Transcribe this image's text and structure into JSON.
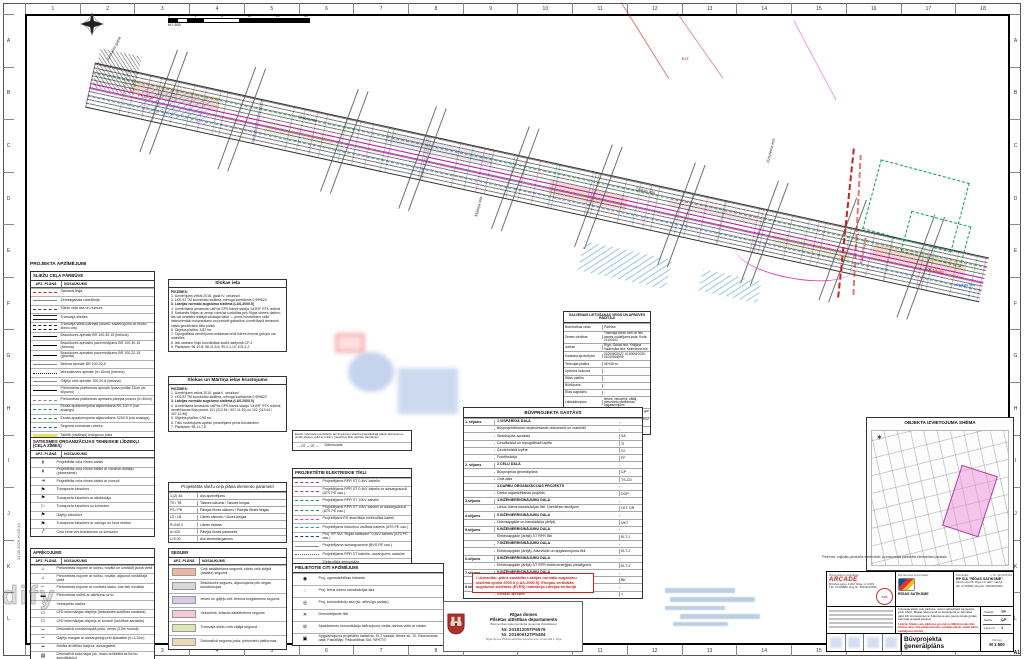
{
  "meta": {
    "sheet_format": "A1",
    "plot_stamp": "24.09.2020 10:15:14",
    "watermark": "dify"
  },
  "frame": {
    "cols": [
      "1",
      "2",
      "3",
      "4",
      "5",
      "6",
      "7",
      "8",
      "9",
      "10",
      "11",
      "12",
      "13",
      "14",
      "15",
      "16",
      "17",
      "18"
    ],
    "rows": [
      "A",
      "B",
      "C",
      "D",
      "E",
      "F",
      "G",
      "H",
      "I",
      "J",
      "K",
      "L"
    ]
  },
  "scalebar": {
    "ticks": [
      "0",
      "1",
      "5",
      "10",
      "20",
      "40"
    ],
    "scale": "M 1:500"
  },
  "legend_title": "PROJEKTA APZĪMĒJUMI",
  "legend_road": {
    "header": "SLIEŽU CEĻA PĀRBŪVE",
    "col1": "APZ. PLĀNĀ",
    "col2": "NOSAUKUMS",
    "rows": [
      {
        "sym": "s-dash-red",
        "label": "Sarkanā līnija"
      },
      {
        "sym": "s-solid-gray",
        "label": "Zemesgabala robežlīnija"
      },
      {
        "sym": "s-axis",
        "label": "Sliežu ceļa ass un numurs"
      },
      {
        "sym": "s-double",
        "label": "Tramvaja sliedes"
      },
      {
        "sym": "s-double-dash",
        "label": "Tramvaja sliežu pārejas posms: savienojums ar esošo sliežu ceļu"
      },
      {
        "sym": "s-solid-black",
        "label": "Brauktuves apmale BR 100.30.15 (betona)"
      },
      {
        "sym": "s-solid-black",
        "label": "Brauktuves apmales pazeminājums BR 100.30.15 (betona)"
      },
      {
        "sym": "s-solid-black",
        "label": "Brauktuves apmales pazeminājums BR 100.22.15 (granīta)"
      },
      {
        "sym": "s-solid-gray",
        "label": "Betona apmale BR 100.20.8"
      },
      {
        "sym": "s-dot-black",
        "label": "Iebrauktuves apmale (h=10cm) (betona)"
      },
      {
        "sym": "s-solid-gray",
        "label": "Gājēju ceļa apmale 100.20.8 (betona)"
      },
      {
        "sym": "s-solid-black",
        "label": "Pieturvietas platformas apmale īpaša profila 33cm (ar slīpumu)"
      },
      {
        "sym": "s-dash-gray",
        "label": "Pieturvietas platformas apmales pārejas posms (h=30cm)"
      },
      {
        "sym": "s-dash-green",
        "label": "Esoša apzaļumojuma atjaunošana RS-100 V (vai analogs)"
      },
      {
        "sym": "s-dash-green",
        "label": "Esoša apzaļumojuma atjaunošana S200.5 (vai analogs)"
      },
      {
        "sym": "s-dash-blue",
        "label": "Seguma nomaiņas robeža"
      },
      {
        "sym": "s-hl-yellow",
        "label": "Taktilā (vadlīniju) iesegumu josla"
      },
      {
        "sym": "s-tree",
        "label": "Esošs, saglabājams koks"
      }
    ]
  },
  "legend_signs": {
    "header": "SATIKSMES ORGANIZĀCIJAS TEHNISKIE LĪDZEKĻI (CEĻA ZĪMES)",
    "col1": "APZ. PLĀNĀ",
    "col2": "NOSAUKUMS",
    "rows": [
      {
        "g": "↟",
        "label": "Projektētās ceļa zīmes balsts"
      },
      {
        "g": "↟",
        "label": "Projektētās ceļa zīmes balsts ar virziena rādītāju (pārnesams)"
      },
      {
        "g": "⇥",
        "label": "Projektētās ceļa zīmes balsts ar konsoli"
      },
      {
        "g": "⚑",
        "label": "Transporta luksofors"
      },
      {
        "g": "⚑",
        "label": "Transporta luksofors ar atkārtotāju"
      },
      {
        "g": "⚐",
        "label": "Transporta luksofors uz konsoles"
      },
      {
        "g": "⚑",
        "label": "Gājēju luksofors"
      },
      {
        "g": "⚑",
        "label": "Transporta luksofors ar vairogu un fona ekrānu"
      },
      {
        "g": "⤤",
        "label": "Ceļa zīme virs brauktuves uz konsoles"
      }
    ]
  },
  "legend_equip": {
    "header": "APRĪKOJUMS",
    "col1": "APZ. PLĀNĀ",
    "col2": "NOSAUKUMS",
    "rows": [
      {
        "g": "⌂",
        "label": "Pieturvietas nojume ar soliņu, novākt un uzstādīt jaunā vietā"
      },
      {
        "g": "⌂",
        "label": "Pieturvietas nojume ar soliņu, novākt; atjaunot norādītajā vietā"
      },
      {
        "g": "⌐",
        "label": "Pieturvietas nojume ar norādes stabu, kas tiek novākta"
      },
      {
        "g": "▬",
        "label": "Pieturvietas soliņš ar atkritumu urnu"
      },
      {
        "g": "⌇",
        "label": "Velosipēdu statīvs"
      },
      {
        "g": "▭",
        "label": "LED informācijas displejs (tiešsaistes kustības saraksts)"
      },
      {
        "g": "▭",
        "label": "LED informācijas displejs ar konsoli (kustības saraksts)"
      },
      {
        "g": "┅",
        "label": "Dekoratīvā norobežojošā josla, zema (3,0m moduļi)"
      },
      {
        "g": "┉",
        "label": "Gājēju margas ar aizsargrežģi pret šļakatām (h=1,10m)"
      },
      {
        "g": "━",
        "label": "Metāla drošības barjera; aizsargsieta"
      },
      {
        "g": "▤",
        "label": "Dekoratīvā koka laipa (sk. mazo arhitektūras formu specifikāciju)"
      }
    ]
  },
  "notes1": {
    "title": "Slokas iela",
    "label": "PIEZĪMES:",
    "items": [
      {
        "t": "1. Uzmērījums veikts 2018. gada IV. ceturksnī",
        "cls": ""
      },
      {
        "t": "2. LKS-92 TM koordinātu sistēma, mēroga koeficients 0,999823",
        "cls": ""
      },
      {
        "t": "3. Latvijas normālo augstumu sistēma (LAS-2000.5)",
        "cls": "bold"
      },
      {
        "t": "4. Uzmērīšanā izmantota LatPos GPS bāzes stacija \"ULBR\" RTK režīmā",
        "cls": ""
      },
      {
        "t": "5. Sarkanās līnijas un zemju robežas uzrādītas pēc Rīgas domes datiem; tās var neatbilst reālajai situācijai dabā — pirms būvdarbiem veikt instrumentālu nospraušanu un precizēt gabarītus; uzmērīšanā izmantoti valsts ģeodēziskā tīkla punkti",
        "cls": ""
      },
      {
        "t": "6. Objekta platība: 3,82 ha",
        "cls": ""
      },
      {
        "t": "7. Topogrāfiskā uzmērījuma veikšanas brīdī ūdens līmenis grāvjos var mainīties",
        "cls": ""
      },
      {
        "t": "8. Ielu sarkano līniju koordinātas skatīt rasējumā ĢP-2",
        "cls": ""
      },
      {
        "t": "9. Planšetes: 98-10-8; 98-11-5,6; 99-2-1,10; 103-4-2",
        "cls": ""
      }
    ]
  },
  "notes2": {
    "title": "Slokas un Mārtiņa ielas krustojums",
    "label": "PIEZĪMES:",
    "items": [
      {
        "t": "1. Uzmērījums veikts 2018. gada II. ceturksnī",
        "cls": ""
      },
      {
        "t": "2. LKS-92 TM koordinātu sistēma, mēroga koeficients 0,999823",
        "cls": ""
      },
      {
        "t": "3. Latvijas normālo augstumu sistēma (LAS-2000.5)",
        "cls": "bold"
      },
      {
        "t": "4. Uzmērīšanā izmantota LatPos GPS bāzes stacija \"ULBR\" RTK režīmā; uzmērīšanas tīkla punkti: 101 (312.54 / 407.11.30) un 102 (313.64 / 407.12.85)",
        "cls": ""
      },
      {
        "t": "5. Objekta platība: 0,98 ha",
        "cls": ""
      },
      {
        "t": "6. Tīklu novietojums apvidū precizējams pirms būvdarbiem",
        "cls": ""
      },
      {
        "t": "7. Planšetes: 98-11-7,8",
        "cls": ""
      }
    ]
  },
  "params": {
    "title": "Projektētās sliežu ceļa plāna elementu parametri",
    "rows": [
      {
        "k": "1-(2) 3A",
        "v": "Ass apzīmējums"
      },
      {
        "k": "TS / TB",
        "v": "Taisnes sākums / Taisnes beigas"
      },
      {
        "k": "PS / PB",
        "v": "Pārejas līknes sākums / Pārejas līknes beigas"
      },
      {
        "k": "LS / LB",
        "v": "Līknes sākums / Līknes beigas"
      },
      {
        "k": "R=240.0",
        "v": "Līknes rādiuss"
      },
      {
        "k": "A=120",
        "v": "Pārejas līknes parametrs"
      },
      {
        "k": "L=0.00",
        "v": "Ass elementa garums"
      }
    ]
  },
  "segumi": {
    "header": "SEGUMI",
    "col1": "APZ. PLĀNĀ",
    "col2": "NOSAUKUMS",
    "rows": [
      {
        "c": "#f0b4a2",
        "label": "Ceļš asfaltbetona segumā; sliežu ceļš slēgtā (asfalta) segumā"
      },
      {
        "c": "#d8d8d8",
        "label": "Brauktuves segums, atjaunojams pēc segas konstrukcijas"
      },
      {
        "c": "#d9c9ea",
        "label": "Ietves un gājēju ceļi: betona bruģakmens segums"
      },
      {
        "c": "#f5c9dc",
        "label": "Veloceliņš: krāsota asfaltbetona segums"
      },
      {
        "c": "#dce8b4",
        "label": "Tramvaja sliežu ceļš zālāja segumā"
      },
      {
        "c": "#ead9ba",
        "label": "Dekoratīvā seguma josla; pieturvietu platformas"
      }
    ]
  },
  "comm": {
    "title": "ESOŠĀS APAKŠZEMES KOMUNIKĀCIJAS",
    "note": "Esošo inženierkomunikāciju apzīmējumus skatīt topogrāfiskajā plānā; šķērsojumu vietās darbus veikt ar rokām, pieaicinot tīklu turētāju pārstāvjus",
    "sym": "— ŪT — ŪT —",
    "label": "Ūdensvads"
  },
  "elec": {
    "title": "PROJEKTĒTIE ELEKTRISKIE TĪKLI",
    "rows": [
      {
        "sym": "s-dash-purple",
        "label": "Projektējams RPR ST 0,4kV kabelis"
      },
      {
        "sym": "s-dash-purple",
        "label": "Projektējams RPR ST 0,4kV kabelis ar aizsargcauruli (ATS PE cau.)"
      },
      {
        "sym": "s-dash-green2",
        "label": "Projektējams RPR ST 10kV kabelis"
      },
      {
        "sym": "s-dash-green2",
        "label": "Projektējams RPR ST 10kV kabelis ar aizsargcauruli (ATS PE cau.)"
      },
      {
        "sym": "s-dash-magenta",
        "label": "Projektējami RS atsevišķie elektrotīkla kabeļi"
      },
      {
        "sym": "s-dash-cyan",
        "label": "Projektējams luksoforu vadības kabelis (ATS PE cau.)"
      },
      {
        "sym": "s-dash-navy",
        "label": "Proj. RP SIA \"Rīgas satiksme\" 0,4kV kabelis (ATS PE cau.)"
      },
      {
        "sym": "s-solid-gray",
        "label": "Projektējama aizsargcaurule (BVS PE cau.)"
      },
      {
        "sym": "s-dot-purple",
        "label": "Projektējams RPR ST kabelis: nozarojums; sadalne"
      },
      {
        "sym": "s-dot-black",
        "label": "Elektrotīkla demontāža"
      }
    ]
  },
  "others": {
    "title": "PIELIETOTIE CITI APZĪMĒJUMI",
    "rows": [
      {
        "g": "◉",
        "label": "Proj. ugunsdzēsības hidrants"
      },
      {
        "g": "◌",
        "label": "Proj. lietus ūdens kanalizācijas aka"
      },
      {
        "g": "◎",
        "label": "Proj. komunikāciju aka (sk. attiecīgo sadaļu)"
      },
      {
        "g": "✕",
        "label": "Demontējamie tīkli"
      },
      {
        "g": "⊘",
        "label": "Apakšzemes komunikāciju šķērsojumu vietās darbus veikt ar rokām"
      },
      {
        "g": "▣",
        "label": "Apgaismojuma projektēto sadali sk. ELT sadaļā; tāmes sk. 10. Ekonomikas daļā; Pasūtītājs: Pašvaldības SIA \"NPETS\""
      }
    ]
  },
  "usage": {
    "title": "GALVENAIS LIETOŠANAS VEIDS UN APBŪVES RĀDĪTĀJI",
    "rows": [
      {
        "k": "Būvniecības veids",
        "v": "Pārbūve"
      },
      {
        "k": "Zemes vienības",
        "v": "Tramvaja sliežu ceļš un ielu zemes nodalījuma josla; Kods: 21100102"
      },
      {
        "k": "Adrese",
        "v": "Rīga, Slokas iela, Krišjāņa Valdemāra iela, Kalnciema iela"
      },
      {
        "k": "Kadastra apzīmējumi",
        "v": "01000602027; 01000610030; 01000616999"
      },
      {
        "k": "Teritorijas platība",
        "v": "38 948 m²"
      },
      {
        "k": "Apbūves laukums",
        "v": "-"
      },
      {
        "k": "Stāvu platība",
        "v": "-"
      },
      {
        "k": "Būvtilpums",
        "v": "-"
      },
      {
        "k": "Ēkas augstums",
        "v": "-"
      },
      {
        "k": "Labiekārtojums",
        "v": "ietves, veloceliņi, zālāji, pieturvietu platformas, apgaismojums"
      },
      {
        "k": "Aizsargjoslas",
        "v": "ekspluatācijas aizsargjoslas gar ielām, tīkliem un sliežu ceļu"
      },
      {
        "k": "Ugunsdrošība",
        "v": "esošie un projektētie hidranti uz ūdensvada"
      },
      {
        "k": "Piebraukšana",
        "v": "no esošajām ielām un krustojumiem"
      }
    ]
  },
  "composition": {
    "title": "BŪVPROJEKTA SASTĀVS",
    "rows": [
      {
        "vol": "1. sējums",
        "nm": "1.VISPĀRĪGĀ DAĻA",
        "cd": "",
        "cls": "b"
      },
      {
        "vol": "",
        "nm": "Būvprojektēšanai nepieciešamie dokumenti un materiāli",
        "cd": "",
        "cls": ""
      },
      {
        "vol": "",
        "nm": "Skaidrojošs apraksts",
        "cd": "SA",
        "cls": ""
      },
      {
        "vol": "",
        "nm": "Ģeodēziskā un topogrāfiskā izpēte",
        "cd": "TI",
        "cls": ""
      },
      {
        "vol": "",
        "nm": "Ģeotehniskā izpēte",
        "cd": "GI",
        "cls": ""
      },
      {
        "vol": "",
        "nm": "Fotofiksācija",
        "cd": "FF",
        "cls": ""
      },
      {
        "vol": "2. sējums",
        "nm": "2.CEĻU DAĻA",
        "cd": "",
        "cls": "b"
      },
      {
        "vol": "",
        "nm": "Būvprojekta ģenerālplāns",
        "cd": "ĢP",
        "cls": ""
      },
      {
        "vol": "",
        "nm": "Ceļa daļa",
        "cd": "TS-CD",
        "cls": ""
      },
      {
        "vol": "",
        "nm": "3.DARBU ORGANIZĀCIJAS PROJEKTS",
        "cd": "",
        "cls": "b"
      },
      {
        "vol": "",
        "nm": "Darbu organizēšanas projekts",
        "cd": "DOP",
        "cls": ""
      },
      {
        "vol": "3.sējums",
        "nm": "4.INŽENIERRISINĀJUMU DAĻA",
        "cd": "",
        "cls": "b"
      },
      {
        "vol": "",
        "nm": "Lietus ūdens kanalizācijas tīkli. Drenāžas risinājumi.",
        "cd": "LKT, DR",
        "cls": ""
      },
      {
        "vol": "4.sējums",
        "nm": "5.INŽENIERRISINĀJUMU DAĻA",
        "cd": "",
        "cls": "b"
      },
      {
        "vol": "",
        "nm": "Ūdensapgāde un kanalizācija (ārējā)",
        "cd": "ŪKT",
        "cls": ""
      },
      {
        "vol": "5.sējums",
        "nm": "6.INŽENIERRISINĀJUMU DAĻA",
        "cd": "",
        "cls": "b"
      },
      {
        "vol": "",
        "nm": "Elektroapgāde (ārējā) ST RPR tīkli",
        "cd": "ELT-1",
        "cls": ""
      },
      {
        "vol": "",
        "nm": "7.INŽENIERRISINĀJUMU DAĻA",
        "cd": "",
        "cls": "b"
      },
      {
        "vol": "",
        "nm": "Elektroapgāde (ārējā). Atsevišķie un apgaismojuma tīkli",
        "cd": "ELT-2",
        "cls": ""
      },
      {
        "vol": "6.sējums",
        "nm": "8.INŽENIERRISINĀJUMU DAĻA",
        "cd": "",
        "cls": "b"
      },
      {
        "vol": "",
        "nm": "Elektroapgāde (ārējā) ST RPR elektroenerģijas pieslēgums",
        "cd": "ELT-3",
        "cls": ""
      },
      {
        "vol": "7.sējums",
        "nm": "9.INŽENIERRISINĀJUMU DAĻA",
        "cd": "",
        "cls": "b"
      },
      {
        "vol": "",
        "nm": "Būvkonstrukcijas",
        "cd": "BK",
        "cls": ""
      },
      {
        "vol": "8.sējums",
        "nm": "10.EKONOMIKAS DAĻA",
        "cd": "",
        "cls": "b"
      },
      {
        "vol": "",
        "nm": "Izmaksu aprēķins",
        "cd": "T",
        "cls": ""
      }
    ]
  },
  "map": {
    "title": "OBJEKTA IZVIETOJUMA SHĒMA",
    "north": "✶"
  },
  "warning": {
    "text": "! Uzmanību: plāns sastādīts Latvijas normālo augstumu sistēmā epohā 2000.5 (LAS-2000.5). Eiropas vertikālās augstumu sistēmas (EVRS) realizācija Latvijas teritorijā"
  },
  "approval": {
    "org1": "Rīgas domes",
    "org2": "Pilsētas attīstības departaments",
    "sub": "Būvniecības dokumentācija pieņemta izskatīšanai",
    "no1": "Nr. 20181205TP6679",
    "no2": "Nr. 20180612TP5484",
    "foot": "Rīgas domes Pilsētas attīstības departaments, Amatu iela 4, Rīga"
  },
  "tb": {
    "note": "Piezīmes: oriģināls parakstīts elektroniski, ja dokumentā paredzēts elektronisks paraksts",
    "designer_label": "Būvprojekta izstrādātājs:",
    "designer_name": "ARCADE",
    "designer_addr1": "Brīvības gatve 214M, Rīga, LV-1039",
    "designer_addr2": "Tālr. 67339880; Reģ.Nr. 40003216090",
    "stamp": "AVS",
    "initiator_label": "Būvniecības ierosinātājs:",
    "initiator_name": "RĪGAS SATIKSME",
    "client_label": "Pasūtītājs:",
    "client_name": "RP SIA \"RĪGAS SATIKSME\"",
    "client_addr1": "Kleistu iela 28, Rīga, LV-1067, Latvija",
    "client_addr2": "tālr. 67104800; Reģ.Nr. 40003619950",
    "contract_label": "Līg. Nr.",
    "contract": "L.Nr. 42/1205164",
    "desc": "Tramvaja sliežu ceļu pārbūve, veicot sabiedriskā transporta joslu izbūvi, Slokas ielā posmā no krustojuma ar Jūrmalas gatvi līdz krustojumam ar Kalnciema ielu, jaunā zemās grīdas tramvaja projekta ietvaros",
    "desc_red": "1.kārta: Sliežu ceļu pārbūve posmā no Mārtiņa ielas līdz Slokas ielas tilta atbalstsienām; pārējās kārtas skatīt kārtu sadalījuma shēmā",
    "info": [
      {
        "k": "Stadija",
        "v": "TP"
      },
      {
        "k": "Marka",
        "v": "ĢP"
      },
      {
        "k": "Lapa Nr.",
        "v": "1"
      }
    ],
    "doc_title": "Būvprojekta ģenerālplāns",
    "scale_label": "Mērogs",
    "scale": "M 1:500"
  },
  "scatter": [
    {
      "text": "Jūrmalas gatve"
    },
    {
      "text": "Slokas iela"
    },
    {
      "text": "Mārtiņa iela"
    },
    {
      "text": "Slokas iela"
    },
    {
      "text": "Dzirciema iela"
    },
    {
      "text": "Kalnciema iela"
    },
    {
      "text": "Slokas iela"
    },
    {
      "text": "PK 0+00"
    },
    {
      "text": "PK 10+50"
    },
    {
      "text": "ELT"
    }
  ]
}
